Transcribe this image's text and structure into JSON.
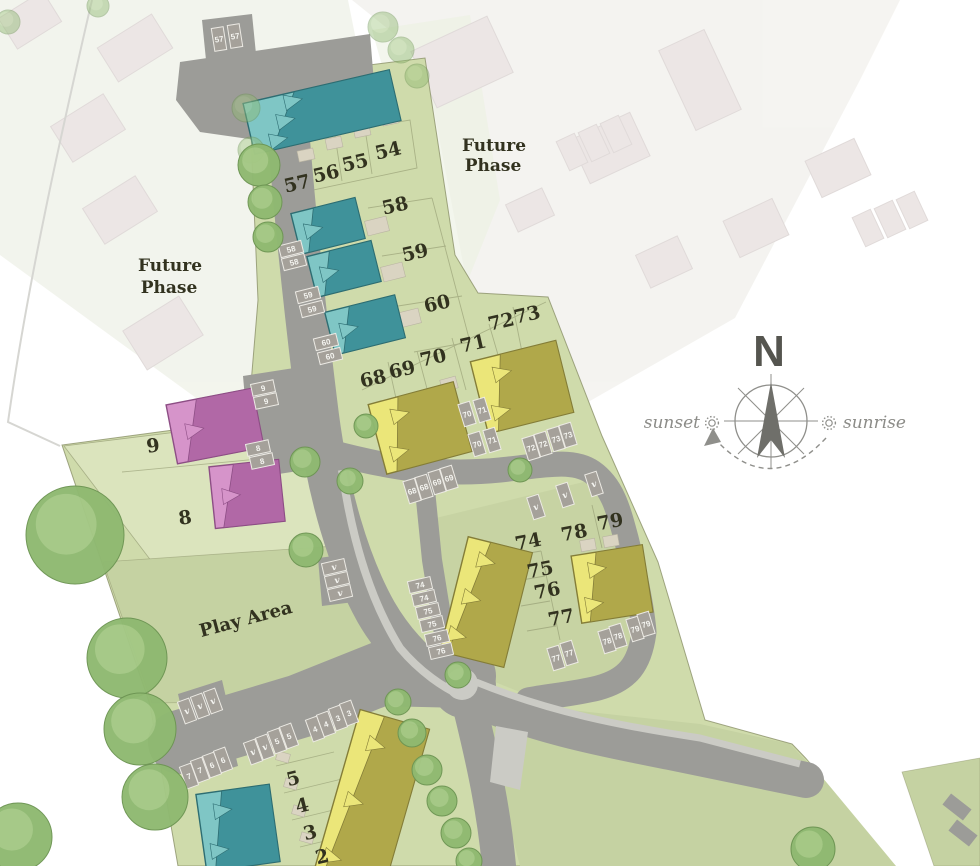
{
  "plan": {
    "areas": {
      "future_phase_line1": "Future",
      "future_phase_line2": "Phase",
      "play_area": "Play Area"
    },
    "compass": {
      "north": "N",
      "sunset": "sunset",
      "sunrise": "sunrise"
    },
    "plot_numbers": [
      {
        "n": "54",
        "x": 388,
        "y": 150,
        "r": -13
      },
      {
        "n": "55",
        "x": 355,
        "y": 162,
        "r": -13
      },
      {
        "n": "56",
        "x": 326,
        "y": 173,
        "r": -13
      },
      {
        "n": "57",
        "x": 297,
        "y": 183,
        "r": -13
      },
      {
        "n": "58",
        "x": 395,
        "y": 205,
        "r": -13
      },
      {
        "n": "59",
        "x": 415,
        "y": 252,
        "r": -13
      },
      {
        "n": "60",
        "x": 437,
        "y": 303,
        "r": -13
      },
      {
        "n": "68",
        "x": 373,
        "y": 378,
        "r": -13
      },
      {
        "n": "69",
        "x": 402,
        "y": 369,
        "r": -13
      },
      {
        "n": "70",
        "x": 433,
        "y": 357,
        "r": -13
      },
      {
        "n": "71",
        "x": 473,
        "y": 343,
        "r": -13
      },
      {
        "n": "72",
        "x": 501,
        "y": 321,
        "r": -13
      },
      {
        "n": "73",
        "x": 527,
        "y": 314,
        "r": -13
      },
      {
        "n": "9",
        "x": 153,
        "y": 445,
        "r": -8
      },
      {
        "n": "8",
        "x": 185,
        "y": 517,
        "r": -8
      },
      {
        "n": "74",
        "x": 528,
        "y": 541,
        "r": -11
      },
      {
        "n": "75",
        "x": 540,
        "y": 569,
        "r": -11
      },
      {
        "n": "76",
        "x": 547,
        "y": 590,
        "r": -11
      },
      {
        "n": "77",
        "x": 561,
        "y": 617,
        "r": -11
      },
      {
        "n": "78",
        "x": 574,
        "y": 532,
        "r": -11
      },
      {
        "n": "79",
        "x": 610,
        "y": 521,
        "r": -11
      },
      {
        "n": "5",
        "x": 293,
        "y": 778,
        "r": -14
      },
      {
        "n": "4",
        "x": 302,
        "y": 805,
        "r": -14
      },
      {
        "n": "3",
        "x": 310,
        "y": 832,
        "r": -14
      },
      {
        "n": "2",
        "x": 322,
        "y": 856,
        "r": -14
      }
    ],
    "parking_labels": [
      {
        "t": "57",
        "x": 219,
        "y": 39,
        "r": -9,
        "o": "v"
      },
      {
        "t": "57",
        "x": 235,
        "y": 36,
        "r": -9,
        "o": "v"
      },
      {
        "t": "58",
        "x": 291,
        "y": 249,
        "r": -14,
        "o": "h"
      },
      {
        "t": "58",
        "x": 294,
        "y": 262,
        "r": -14,
        "o": "h"
      },
      {
        "t": "59",
        "x": 308,
        "y": 295,
        "r": -14,
        "o": "h"
      },
      {
        "t": "59",
        "x": 312,
        "y": 309,
        "r": -14,
        "o": "h"
      },
      {
        "t": "60",
        "x": 326,
        "y": 342,
        "r": -14,
        "o": "h"
      },
      {
        "t": "60",
        "x": 330,
        "y": 356,
        "r": -14,
        "o": "h"
      },
      {
        "t": "9",
        "x": 263,
        "y": 388,
        "r": -12,
        "o": "h"
      },
      {
        "t": "9",
        "x": 266,
        "y": 401,
        "r": -12,
        "o": "h"
      },
      {
        "t": "8",
        "x": 258,
        "y": 448,
        "r": -12,
        "o": "h"
      },
      {
        "t": "8",
        "x": 262,
        "y": 461,
        "r": -12,
        "o": "h"
      },
      {
        "t": "70",
        "x": 467,
        "y": 414,
        "r": -17,
        "o": "v"
      },
      {
        "t": "71",
        "x": 482,
        "y": 410,
        "r": -17,
        "o": "v"
      },
      {
        "t": "70",
        "x": 477,
        "y": 444,
        "r": -17,
        "o": "v"
      },
      {
        "t": "71",
        "x": 492,
        "y": 440,
        "r": -17,
        "o": "v"
      },
      {
        "t": "72",
        "x": 531,
        "y": 448,
        "r": -17,
        "o": "v"
      },
      {
        "t": "72",
        "x": 543,
        "y": 444,
        "r": -17,
        "o": "v"
      },
      {
        "t": "73",
        "x": 556,
        "y": 439,
        "r": -17,
        "o": "v"
      },
      {
        "t": "73",
        "x": 568,
        "y": 435,
        "r": -17,
        "o": "v"
      },
      {
        "t": "68",
        "x": 412,
        "y": 491,
        "r": -17,
        "o": "v"
      },
      {
        "t": "68",
        "x": 424,
        "y": 487,
        "r": -17,
        "o": "v"
      },
      {
        "t": "69",
        "x": 437,
        "y": 482,
        "r": -17,
        "o": "v"
      },
      {
        "t": "69",
        "x": 449,
        "y": 478,
        "r": -17,
        "o": "v"
      },
      {
        "t": "v",
        "x": 536,
        "y": 507,
        "r": -18,
        "o": "v"
      },
      {
        "t": "v",
        "x": 565,
        "y": 495,
        "r": -18,
        "o": "v"
      },
      {
        "t": "v",
        "x": 594,
        "y": 484,
        "r": -18,
        "o": "v"
      },
      {
        "t": "v",
        "x": 334,
        "y": 567,
        "r": -13,
        "o": "h"
      },
      {
        "t": "v",
        "x": 337,
        "y": 580,
        "r": -13,
        "o": "h"
      },
      {
        "t": "v",
        "x": 340,
        "y": 593,
        "r": -13,
        "o": "h"
      },
      {
        "t": "74",
        "x": 420,
        "y": 585,
        "r": -13,
        "o": "h"
      },
      {
        "t": "74",
        "x": 424,
        "y": 598,
        "r": -13,
        "o": "h"
      },
      {
        "t": "75",
        "x": 428,
        "y": 611,
        "r": -13,
        "o": "h"
      },
      {
        "t": "75",
        "x": 432,
        "y": 624,
        "r": -13,
        "o": "h"
      },
      {
        "t": "76",
        "x": 437,
        "y": 638,
        "r": -13,
        "o": "h"
      },
      {
        "t": "76",
        "x": 441,
        "y": 651,
        "r": -13,
        "o": "h"
      },
      {
        "t": "77",
        "x": 556,
        "y": 658,
        "r": -17,
        "o": "v"
      },
      {
        "t": "77",
        "x": 569,
        "y": 653,
        "r": -17,
        "o": "v"
      },
      {
        "t": "78",
        "x": 607,
        "y": 641,
        "r": -17,
        "o": "v"
      },
      {
        "t": "78",
        "x": 618,
        "y": 636,
        "r": -17,
        "o": "v"
      },
      {
        "t": "79",
        "x": 635,
        "y": 629,
        "r": -17,
        "o": "v"
      },
      {
        "t": "79",
        "x": 646,
        "y": 624,
        "r": -17,
        "o": "v"
      },
      {
        "t": "v",
        "x": 187,
        "y": 711,
        "r": -20,
        "o": "v"
      },
      {
        "t": "v",
        "x": 200,
        "y": 706,
        "r": -20,
        "o": "v"
      },
      {
        "t": "v",
        "x": 213,
        "y": 701,
        "r": -20,
        "o": "v"
      },
      {
        "t": "7",
        "x": 189,
        "y": 776,
        "r": -20,
        "o": "v"
      },
      {
        "t": "7",
        "x": 200,
        "y": 770,
        "r": -20,
        "o": "v"
      },
      {
        "t": "6",
        "x": 212,
        "y": 765,
        "r": -20,
        "o": "v"
      },
      {
        "t": "6",
        "x": 223,
        "y": 760,
        "r": -20,
        "o": "v"
      },
      {
        "t": "v",
        "x": 253,
        "y": 752,
        "r": -20,
        "o": "v"
      },
      {
        "t": "v",
        "x": 265,
        "y": 747,
        "r": -20,
        "o": "v"
      },
      {
        "t": "5",
        "x": 277,
        "y": 741,
        "r": -20,
        "o": "v"
      },
      {
        "t": "5",
        "x": 289,
        "y": 736,
        "r": -20,
        "o": "v"
      },
      {
        "t": "4",
        "x": 315,
        "y": 729,
        "r": -20,
        "o": "v"
      },
      {
        "t": "4",
        "x": 326,
        "y": 724,
        "r": -20,
        "o": "v"
      },
      {
        "t": "3",
        "x": 338,
        "y": 718,
        "r": -20,
        "o": "v"
      },
      {
        "t": "3",
        "x": 349,
        "y": 713,
        "r": -20,
        "o": "v"
      }
    ],
    "colors": {
      "road": "#9c9c98",
      "road_light": "#cbcbc5",
      "parking_bay": "#a5a19a",
      "bay_stroke": "#eceae4",
      "green_main": "#cfdbab",
      "green_light": "#dbe4bd",
      "green_field": "#c5d2a2",
      "divider": "#8b9169",
      "teal_light": "#7fc6c5",
      "teal_dark": "#3f929a",
      "teal_outline": "#2d6d72",
      "yellow_light": "#ebe679",
      "yellow_dark": "#b0a84a",
      "yellow_outline": "#847d38",
      "pink_light": "#d694ca",
      "pink_dark": "#b168a6",
      "pink_outline": "#8d4e85",
      "beige": "#dad4c2",
      "beige_edge": "#b9b4a2",
      "tree_fill": "#8fb971",
      "tree_inner": "#a9cc8b",
      "tree_edge": "#6d9553",
      "faded_house": "#ddd3d1",
      "faded_outline": "#c8bdbb",
      "faded_base_left": "#e9ecdf",
      "faded_base_right": "#ecebe5",
      "faded_green": "#e0e7cf",
      "label_text": "#32321f",
      "parking_text": "#f4f4f0",
      "compass": "#8f8f8b",
      "compass_text": "#55554f",
      "boundary": "#d6d6d2",
      "white": "#ffffff"
    }
  }
}
